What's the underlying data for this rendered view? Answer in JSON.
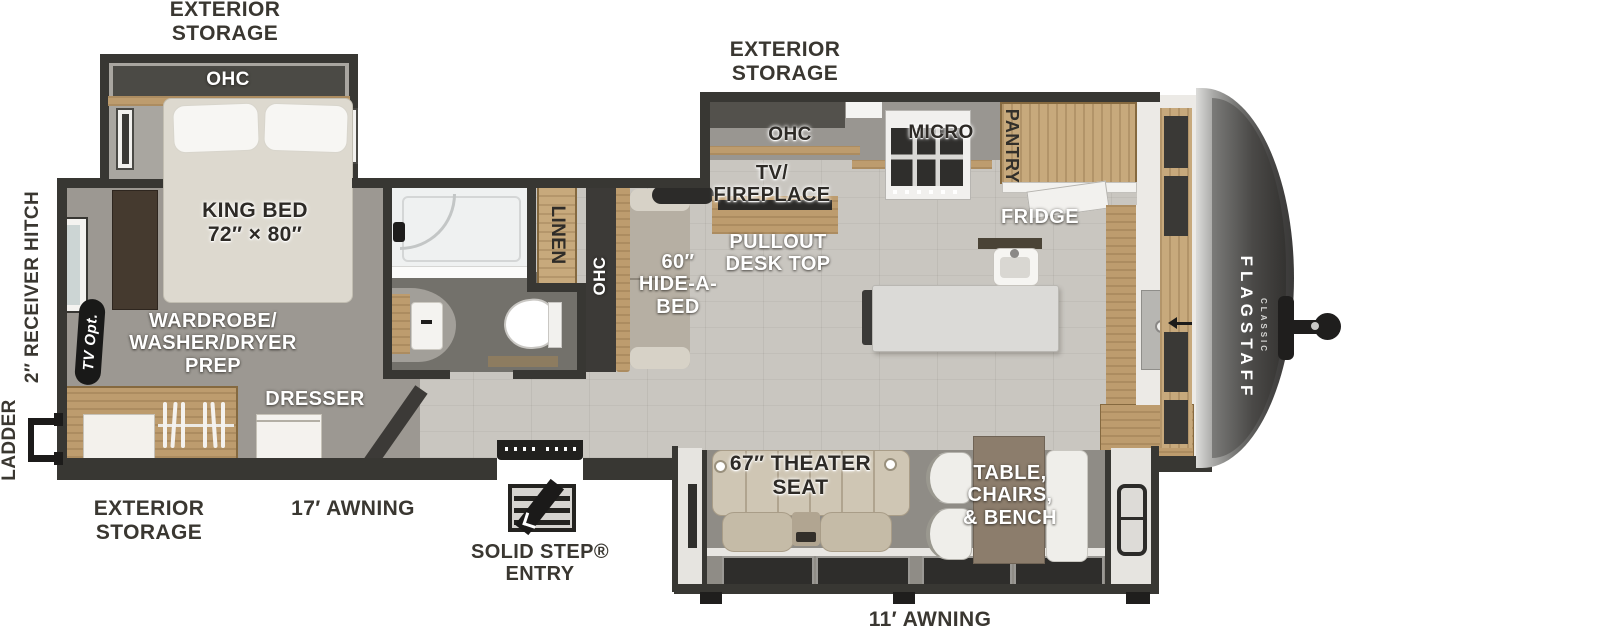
{
  "colors": {
    "wall": "#383733",
    "wood": "#bd9c6e",
    "floor": "#c9c6c0",
    "carpet": "#9c9892",
    "bath_floor": "#73716b",
    "slide_floor": "#8f8c86",
    "cap_dark": "#3a3938",
    "label_dark": "#3a3731",
    "label_white": "#ffffff"
  },
  "exterior": {
    "storage_top_left": "EXTERIOR\nSTORAGE",
    "storage_top_right": "EXTERIOR\nSTORAGE",
    "storage_bottom_left": "EXTERIOR\nSTORAGE",
    "awning_door_side": "17′ AWNING",
    "awning_camp_side": "11′ AWNING",
    "entry": "SOLID STEP®\nENTRY",
    "ladder": "LADDER",
    "receiver_hitch": "2″ RECEIVER HITCH"
  },
  "bedroom": {
    "ohc": "OHC",
    "king_bed": "KING BED\n72″ × 80″",
    "tv_opt": "TV Opt.",
    "wardrobe": "WARDROBE/\nWASHER/DRYER\nPREP",
    "dresser": "DRESSER"
  },
  "bathroom": {
    "linen": "LINEN"
  },
  "hall": {
    "ohc": "OHC",
    "hide_a_bed": "60″\nHIDE-A-\nBED"
  },
  "kitchen": {
    "ohc": "OHC",
    "tv_fireplace": "TV/\nFIREPLACE",
    "pullout_desk": "PULLOUT\nDESK TOP",
    "micro": "MICRO",
    "pantry": "PANTRY",
    "fridge": "FRIDGE",
    "front_ohc": "OHC"
  },
  "living": {
    "theater_seat": "67″ THEATER\nSEAT",
    "dinette": "TABLE,\nCHAIRS,\n& BENCH"
  },
  "brand": {
    "name": "FLAGSTAFF",
    "series": "CLASSIC"
  }
}
